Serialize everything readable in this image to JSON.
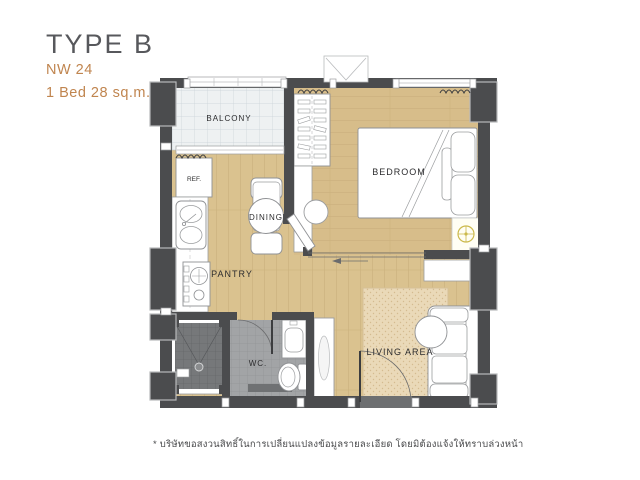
{
  "header": {
    "title": "TYPE B",
    "unit_code": "NW 24",
    "unit_spec": "1 Bed 28 sq.m."
  },
  "plan": {
    "labels": {
      "balcony": "BALCONY",
      "bedroom": "BEDROOM",
      "dining": "DINING",
      "pantry": "PANTRY",
      "wc": "WC.",
      "living_area": "LIVING AREA",
      "refrigerator": "REF."
    }
  },
  "footnote": "* บริษัทขอสงวนสิทธิ์ในการเปลี่ยนแปลงข้อมูลรายละเอียด โดยมิต้องแจ้งให้ทราบล่วงหน้า",
  "colors": {
    "accent": "#c0854f",
    "title_text": "#57585c",
    "wall": "#4b4c4e",
    "wood_floor": "#dac28f",
    "balcony_tile": "#eef1f2",
    "shower_tile": "#76787a",
    "wc_tile": "#a2a4a6",
    "rug": "#ead9b8",
    "light_symbol": "#cbb94b"
  }
}
